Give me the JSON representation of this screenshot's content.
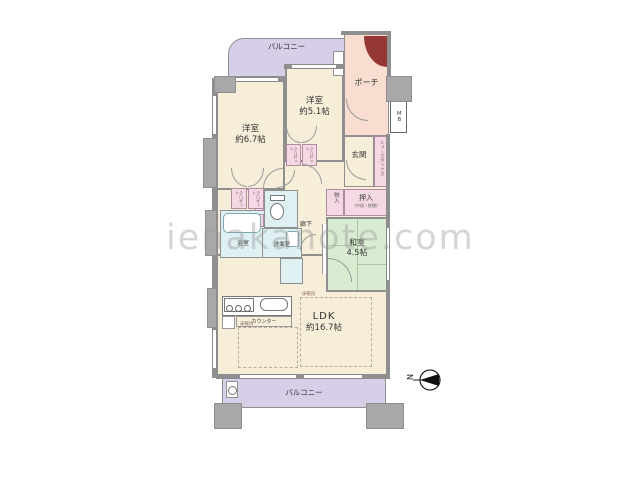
{
  "watermark": "ienakanote.com",
  "compass": {
    "north": "N"
  },
  "colors": {
    "room_cream": "#f6eed9",
    "balcony_purple": "#d7cfe7",
    "porch_pink": "#f9ddd1",
    "storage_pink": "#f4d8e3",
    "tatami_green": "#d9ecd2",
    "water_blue": "#def0f2",
    "wall_gray": "#8f8f8f",
    "pillar_gray": "#a8a8a8",
    "entry_door_red": "#953735"
  },
  "rooms": {
    "balcony_top": {
      "label": "バルコニー"
    },
    "balcony_bottom": {
      "label": "バルコニー"
    },
    "porch": {
      "label": "ポーチ"
    },
    "meter_box": {
      "label": "MB"
    },
    "western_small": {
      "label": "洋室",
      "size": "約5.1帖"
    },
    "western_large": {
      "label": "洋室",
      "size": "約6.7帖"
    },
    "entrance": {
      "label": "玄関"
    },
    "shoes_box": {
      "label": "シューズボックス"
    },
    "closet": {
      "label": "クロゼット"
    },
    "oshiire": {
      "label": "押入",
      "note": "(中段・枕棚)"
    },
    "storage": {
      "label": "物入"
    },
    "japanese_room": {
      "label": "和室",
      "size": "4.5帖"
    },
    "hallway": {
      "label": "廊下"
    },
    "bathroom": {
      "label": "浴室"
    },
    "washroom": {
      "label": "洗面室"
    },
    "ldk": {
      "label": "LDK",
      "size": "約16.7帖"
    },
    "counter": {
      "label": "カウンター"
    },
    "floor_heating": {
      "label": "床暖房"
    }
  }
}
